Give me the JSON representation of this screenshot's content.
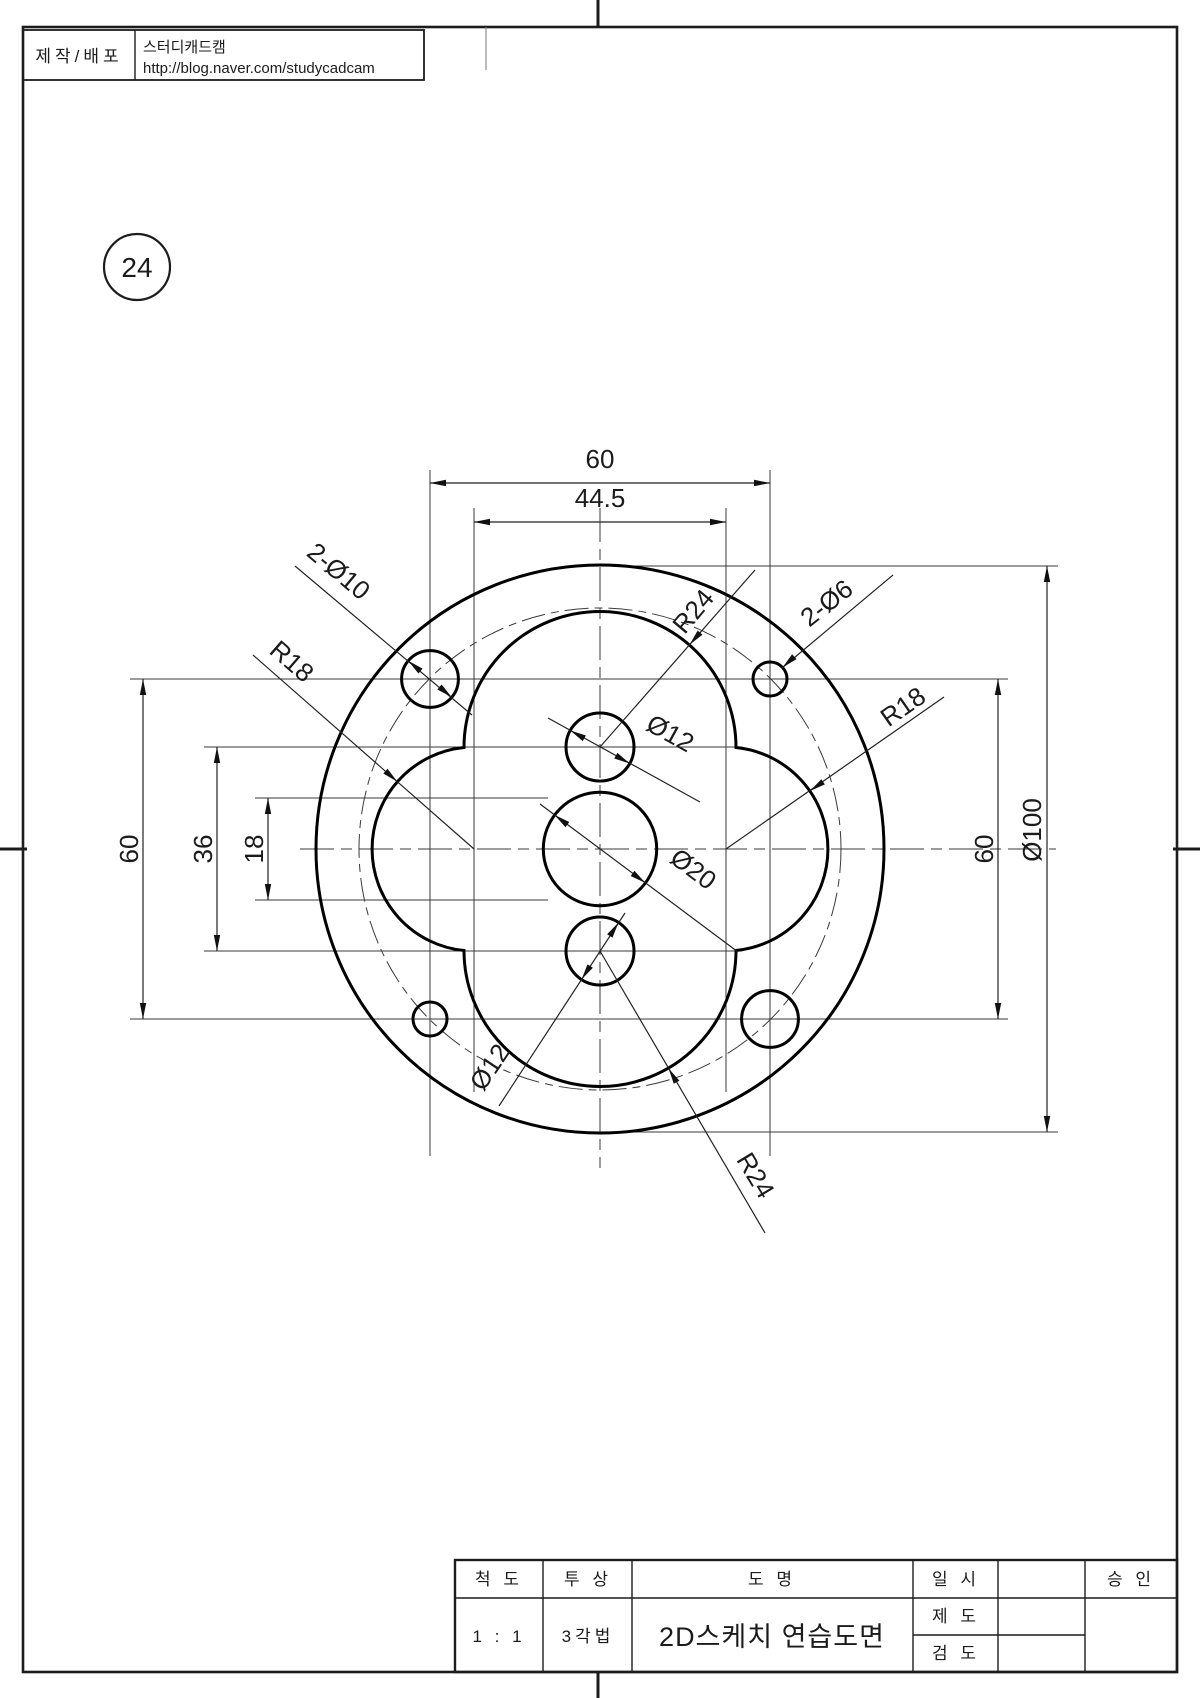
{
  "sheet": {
    "part_number": "24"
  },
  "info_box": {
    "label": "제작/배포",
    "company": "스터디캐드캠",
    "url": "http://blog.naver.com/studycadcam"
  },
  "dimensions": {
    "bolt_span_top": "60",
    "lobe_center_span": "44.5",
    "bolt_span_left": "60",
    "hole_span_left": "36",
    "center_span_left": "18",
    "bolt_span_right": "60",
    "outer_diameter": "Ø100",
    "holes_large": "2-Ø10",
    "holes_small": "2-Ø6",
    "radius_top": "R24",
    "radius_bottom": "R24",
    "radius_left": "R18",
    "radius_right": "R18",
    "hole_top": "Ø12",
    "hole_bottom": "Ø12",
    "hole_center": "Ø20"
  },
  "title_block": {
    "scale_label": "척 도",
    "projection_label": "투 상",
    "name_label": "도 명",
    "date_label": "일 시",
    "draft_label": "제 도",
    "check_label": "검 도",
    "approve_label": "승 인",
    "scale_value": "1 : 1",
    "projection_value": "3각법",
    "name_value": "2D스케치 연습도면"
  },
  "colors": {
    "line": "#1c1c1c",
    "thin": "#3a3a3a",
    "background": "#ffffff"
  }
}
